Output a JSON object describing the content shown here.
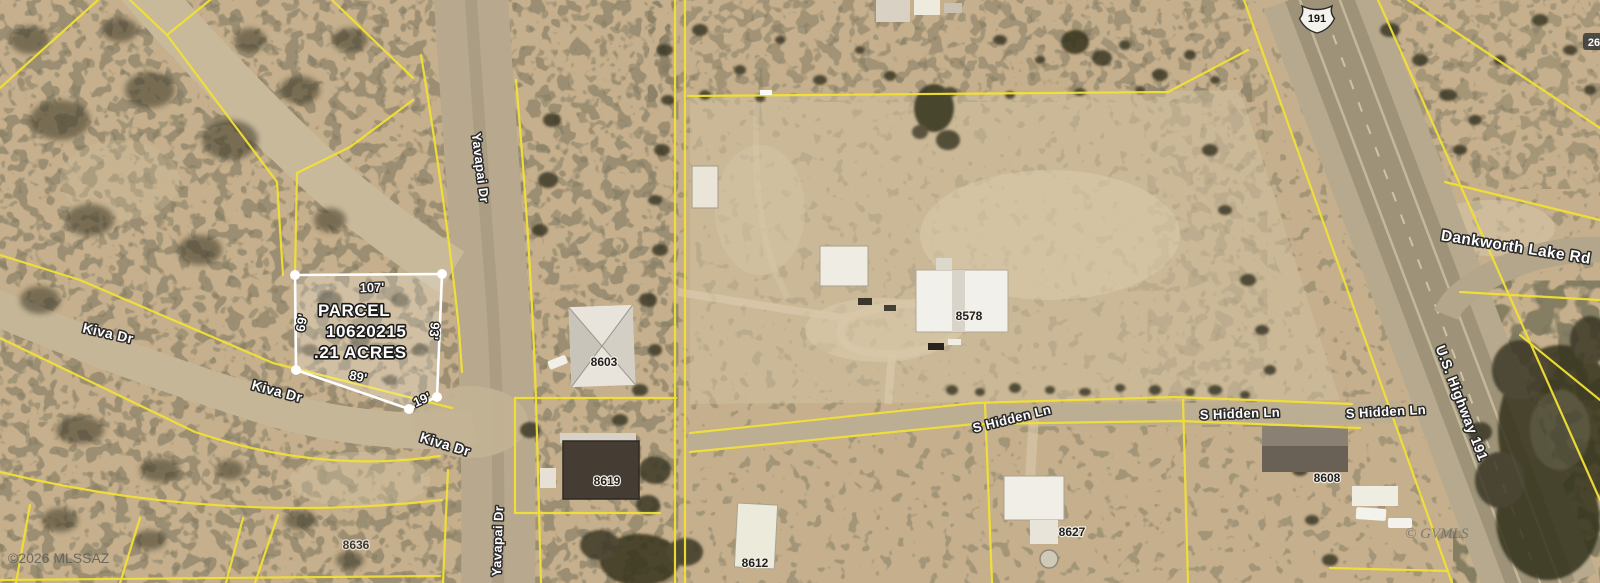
{
  "map": {
    "parcel_highlight": {
      "title": "PARCEL",
      "number": "10620215",
      "acreage": ".21 ACRES",
      "dim_top": "107'",
      "dim_left": "69'",
      "dim_right": "93'",
      "dim_bottom": "89'",
      "dim_corner": "19'"
    },
    "road_labels": {
      "yavapai_north": "Yavapai Dr",
      "yavapai_south": "Yavapai Dr",
      "kiva_west": "Kiva Dr",
      "kiva_mid": "Kiva Dr",
      "kiva_east": "Kiva Dr",
      "s_hidden_west": "S Hidden Ln",
      "s_hidden_mid": "S Hidden Ln",
      "s_hidden_east": "S Hidden Ln",
      "dankworth": "Dankworth Lake Rd",
      "us_highway": "U.S. Highway 191",
      "highway_shield": "191"
    },
    "house_numbers": {
      "h8603": "8603",
      "h8619": "8619",
      "h8636": "8636",
      "h8578": "8578",
      "h8612": "8612",
      "h8627": "8627",
      "h8608": "8608",
      "edge_partial": "26"
    },
    "watermarks": {
      "mls_left": "©2026 MLSSAZ",
      "mls_right": "© GVMLS"
    },
    "colors": {
      "parcel_line": "#f2e135",
      "highlight_outline": "#ffffff",
      "terrain": "#c8b290"
    }
  }
}
